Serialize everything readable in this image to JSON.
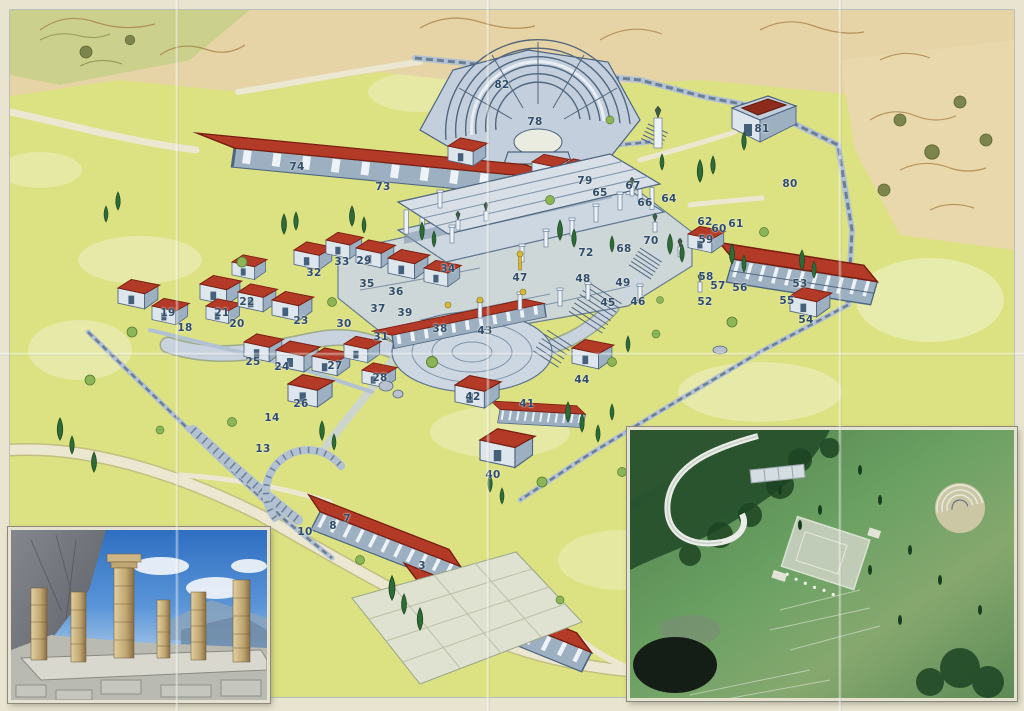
{
  "map": {
    "numbers": [
      {
        "n": "82",
        "x": 502,
        "y": 85
      },
      {
        "n": "78",
        "x": 535,
        "y": 122
      },
      {
        "n": "74",
        "x": 297,
        "y": 167
      },
      {
        "n": "79",
        "x": 585,
        "y": 181
      },
      {
        "n": "73",
        "x": 383,
        "y": 187
      },
      {
        "n": "81",
        "x": 762,
        "y": 129
      },
      {
        "n": "80",
        "x": 790,
        "y": 184
      },
      {
        "n": "67",
        "x": 633,
        "y": 186
      },
      {
        "n": "65",
        "x": 600,
        "y": 193
      },
      {
        "n": "64",
        "x": 669,
        "y": 199
      },
      {
        "n": "66",
        "x": 645,
        "y": 203
      },
      {
        "n": "62",
        "x": 705,
        "y": 222
      },
      {
        "n": "61",
        "x": 736,
        "y": 224
      },
      {
        "n": "60",
        "x": 719,
        "y": 229
      },
      {
        "n": "59",
        "x": 706,
        "y": 240
      },
      {
        "n": "70",
        "x": 651,
        "y": 241
      },
      {
        "n": "68",
        "x": 624,
        "y": 249
      },
      {
        "n": "72",
        "x": 586,
        "y": 253
      },
      {
        "n": "29",
        "x": 364,
        "y": 261
      },
      {
        "n": "33",
        "x": 342,
        "y": 262
      },
      {
        "n": "34",
        "x": 448,
        "y": 269
      },
      {
        "n": "32",
        "x": 314,
        "y": 273
      },
      {
        "n": "58",
        "x": 706,
        "y": 277
      },
      {
        "n": "47",
        "x": 520,
        "y": 278
      },
      {
        "n": "48",
        "x": 583,
        "y": 279
      },
      {
        "n": "49",
        "x": 623,
        "y": 283
      },
      {
        "n": "35",
        "x": 367,
        "y": 284
      },
      {
        "n": "53",
        "x": 800,
        "y": 284
      },
      {
        "n": "57",
        "x": 718,
        "y": 286
      },
      {
        "n": "56",
        "x": 740,
        "y": 288
      },
      {
        "n": "36",
        "x": 396,
        "y": 292
      },
      {
        "n": "55",
        "x": 787,
        "y": 301
      },
      {
        "n": "46",
        "x": 638,
        "y": 302
      },
      {
        "n": "52",
        "x": 705,
        "y": 302
      },
      {
        "n": "22",
        "x": 247,
        "y": 302
      },
      {
        "n": "45",
        "x": 608,
        "y": 303
      },
      {
        "n": "37",
        "x": 378,
        "y": 309
      },
      {
        "n": "39",
        "x": 405,
        "y": 313
      },
      {
        "n": "21",
        "x": 222,
        "y": 313
      },
      {
        "n": "19",
        "x": 168,
        "y": 313
      },
      {
        "n": "54",
        "x": 806,
        "y": 320
      },
      {
        "n": "23",
        "x": 301,
        "y": 321
      },
      {
        "n": "30",
        "x": 344,
        "y": 324
      },
      {
        "n": "20",
        "x": 237,
        "y": 324
      },
      {
        "n": "18",
        "x": 185,
        "y": 328
      },
      {
        "n": "38",
        "x": 440,
        "y": 329
      },
      {
        "n": "43",
        "x": 485,
        "y": 331
      },
      {
        "n": "31",
        "x": 381,
        "y": 337
      },
      {
        "n": "25",
        "x": 253,
        "y": 362
      },
      {
        "n": "27",
        "x": 335,
        "y": 366
      },
      {
        "n": "24",
        "x": 282,
        "y": 367
      },
      {
        "n": "28",
        "x": 380,
        "y": 378
      },
      {
        "n": "44",
        "x": 582,
        "y": 380
      },
      {
        "n": "42",
        "x": 473,
        "y": 397
      },
      {
        "n": "26",
        "x": 301,
        "y": 404
      },
      {
        "n": "41",
        "x": 527,
        "y": 404
      },
      {
        "n": "14",
        "x": 272,
        "y": 418
      },
      {
        "n": "13",
        "x": 263,
        "y": 449
      },
      {
        "n": "40",
        "x": 493,
        "y": 475
      },
      {
        "n": "7",
        "x": 347,
        "y": 519
      },
      {
        "n": "8",
        "x": 333,
        "y": 526
      },
      {
        "n": "10",
        "x": 305,
        "y": 532
      },
      {
        "n": "3",
        "x": 422,
        "y": 566
      }
    ],
    "palette": {
      "paper": "#e8e4d0",
      "grass": "#dce182",
      "grass-light": "#eef1c6",
      "stone": "#c3cfdc",
      "stone-light": "#dde5ed",
      "stone-mid": "#9db0c2",
      "paved": "#cdd7e2",
      "ink": "#4c6580",
      "roof": "#b23a26",
      "roof-dark": "#771d10",
      "tree": "#2f6b37",
      "bush": "#8db457",
      "mountain": "#e7d4a6",
      "mountain-ink": "#a1763c",
      "marker": "#2e4c6e",
      "road": "#ece7d0",
      "photo-sky": "#3f78c4",
      "photo-green": "#5d8f57"
    }
  }
}
